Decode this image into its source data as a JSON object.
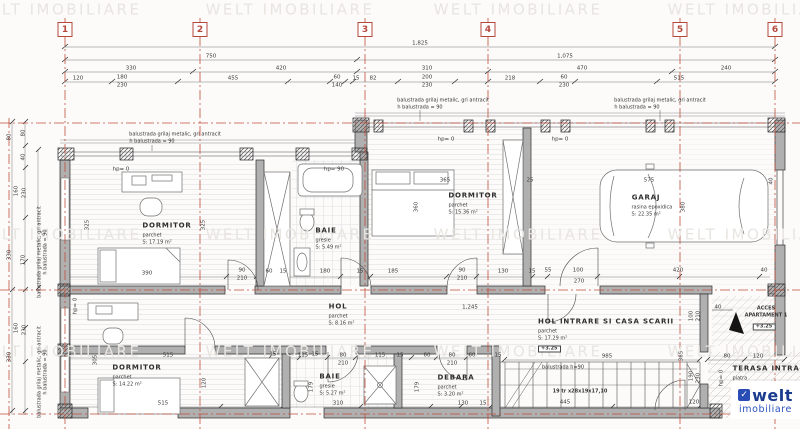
{
  "palette": {
    "red": "#b5483c",
    "line": "#3a3a3a",
    "watermark": "#e8e5e1",
    "logo_blue": "#1b3c8f",
    "logo_blue2": "#2a52be"
  },
  "watermark_text": "WELT IMOBILIARE",
  "grid_bubbles": [
    {
      "n": "1",
      "x": 65
    },
    {
      "n": "2",
      "x": 200
    },
    {
      "n": "3",
      "x": 365
    },
    {
      "n": "4",
      "x": 488
    },
    {
      "n": "5",
      "x": 680
    },
    {
      "n": "6",
      "x": 775
    }
  ],
  "rooms": [
    {
      "id": "dormitor-1",
      "name": "DORMITOR",
      "finish": "parchet",
      "area": "S: 17.19 m²",
      "x": 167,
      "y": 226
    },
    {
      "id": "baie-1",
      "name": "BAIE",
      "finish": "gresie",
      "area": "S: 5.49 m²",
      "x": 326,
      "y": 231
    },
    {
      "id": "dormitor-2",
      "name": "DORMITOR",
      "finish": "parchet",
      "area": "S: 15.36 m²",
      "x": 473,
      "y": 196
    },
    {
      "id": "garaj",
      "name": "GARAJ",
      "finish": "rasina epoxidica",
      "area": "S: 22.35 m²",
      "x": 646,
      "y": 198
    },
    {
      "id": "hol",
      "name": "HOL",
      "finish": "parchet",
      "area": "S: 8.16 m²",
      "x": 338,
      "y": 307
    },
    {
      "id": "hol-intrare",
      "name": "HOL INTRARE SI CASA SCARII",
      "finish": "parchet",
      "area": "S: 17.29 m²",
      "level": "+3.25",
      "x": 606,
      "y": 322
    },
    {
      "id": "dormitor-3",
      "name": "DORMITOR",
      "finish": "parchet",
      "area": "S: 14.22 m²",
      "x": 137,
      "y": 368
    },
    {
      "id": "baie-2",
      "name": "BAIE",
      "finish": "gresie",
      "area": "S: 5.27 m²",
      "x": 330,
      "y": 377
    },
    {
      "id": "debara",
      "name": "DEBARA",
      "finish": "parchet",
      "area": "S: 3.20 m²",
      "x": 456,
      "y": 378
    },
    {
      "id": "terasa-intrare",
      "name": "TERASA INTRARE",
      "finish": "piatra",
      "x": 772,
      "y": 369
    }
  ],
  "labels": [
    {
      "t": "WELT IMOBILIARE",
      "x": 57,
      "y": 10,
      "k": "wm",
      "n": "watermark"
    },
    {
      "t": "WELT IMOBILIARE",
      "x": 290,
      "y": 10,
      "k": "wm",
      "n": "watermark"
    },
    {
      "t": "WELT IMOBILIARE",
      "x": 518,
      "y": 10,
      "k": "wm",
      "n": "watermark"
    },
    {
      "t": "WELT IMOBILIARE",
      "x": 752,
      "y": 10,
      "k": "wm",
      "n": "watermark"
    },
    {
      "t": "WELT IMOBILIARE",
      "x": 57,
      "y": 235,
      "k": "wm",
      "n": "watermark"
    },
    {
      "t": "WELT IMOBILIARE",
      "x": 290,
      "y": 235,
      "k": "wm",
      "n": "watermark"
    },
    {
      "t": "WELT IMOBILIARE",
      "x": 518,
      "y": 235,
      "k": "wm",
      "n": "watermark"
    },
    {
      "t": "WELT IMOBILIARE",
      "x": 752,
      "y": 235,
      "k": "wm",
      "n": "watermark"
    },
    {
      "t": "WELT IMOBILIARE",
      "x": 57,
      "y": 352,
      "k": "wm",
      "n": "watermark"
    },
    {
      "t": "WELT IMOBILIARE",
      "x": 290,
      "y": 352,
      "k": "wm",
      "n": "watermark"
    },
    {
      "t": "WELT IMOBILIARE",
      "x": 518,
      "y": 352,
      "k": "wm",
      "n": "watermark"
    },
    {
      "t": "WELT IMOBILIARE",
      "x": 752,
      "y": 352,
      "k": "wm",
      "n": "watermark"
    },
    {
      "t": "1,825",
      "x": 420,
      "y": 44
    },
    {
      "t": "750",
      "x": 211,
      "y": 57
    },
    {
      "t": "1,075",
      "x": 565,
      "y": 57
    },
    {
      "t": "330",
      "x": 131,
      "y": 69
    },
    {
      "t": "420",
      "x": 281,
      "y": 69
    },
    {
      "t": "310",
      "x": 427,
      "y": 69
    },
    {
      "t": "470",
      "x": 582,
      "y": 69
    },
    {
      "t": "240",
      "x": 726,
      "y": 69
    },
    {
      "t": "120",
      "x": 78,
      "y": 79
    },
    {
      "t": "180",
      "x": 122,
      "y": 78
    },
    {
      "t": "230",
      "x": 122,
      "y": 86
    },
    {
      "t": "455",
      "x": 233,
      "y": 79
    },
    {
      "t": "60",
      "x": 337,
      "y": 78
    },
    {
      "t": "140",
      "x": 337,
      "y": 86
    },
    {
      "t": "15",
      "x": 356,
      "y": 79
    },
    {
      "t": "82",
      "x": 373,
      "y": 79
    },
    {
      "t": "200",
      "x": 427,
      "y": 78
    },
    {
      "t": "230",
      "x": 427,
      "y": 86
    },
    {
      "t": "218",
      "x": 510,
      "y": 79
    },
    {
      "t": "60",
      "x": 564,
      "y": 78
    },
    {
      "t": "230",
      "x": 564,
      "y": 86
    },
    {
      "t": "515",
      "x": 679,
      "y": 79
    },
    {
      "t": "80",
      "x": 10,
      "y": 137,
      "r": -90
    },
    {
      "t": "80",
      "x": 24,
      "y": 133,
      "r": -90
    },
    {
      "t": "40",
      "x": 24,
      "y": 157,
      "r": -90
    },
    {
      "t": "160",
      "x": 17,
      "y": 191,
      "r": -90
    },
    {
      "t": "230",
      "x": 25,
      "y": 193,
      "r": -90
    },
    {
      "t": "330",
      "x": 10,
      "y": 255,
      "r": -90
    },
    {
      "t": "170",
      "x": 24,
      "y": 260,
      "r": -90
    },
    {
      "t": "160",
      "x": 17,
      "y": 328,
      "r": -90
    },
    {
      "t": "230",
      "x": 25,
      "y": 330,
      "r": -90
    },
    {
      "t": "330",
      "x": 10,
      "y": 357,
      "r": -90
    },
    {
      "t": "575",
      "x": 649,
      "y": 181
    },
    {
      "t": "365",
      "x": 445,
      "y": 181
    },
    {
      "t": "25",
      "x": 530,
      "y": 181
    },
    {
      "t": "40",
      "x": 772,
      "y": 181,
      "r": -90
    },
    {
      "t": "380",
      "x": 684,
      "y": 207,
      "r": -90
    },
    {
      "t": "360",
      "x": 417,
      "y": 207,
      "r": -90
    },
    {
      "t": "325",
      "x": 88,
      "y": 225,
      "r": -90
    },
    {
      "t": "325",
      "x": 204,
      "y": 225,
      "r": -90
    },
    {
      "t": "390",
      "x": 147,
      "y": 274
    },
    {
      "t": "90",
      "x": 242,
      "y": 271
    },
    {
      "t": "210",
      "x": 242,
      "y": 279
    },
    {
      "t": "60",
      "x": 269,
      "y": 272
    },
    {
      "t": "15",
      "x": 283,
      "y": 272
    },
    {
      "t": "180",
      "x": 325,
      "y": 272
    },
    {
      "t": "15",
      "x": 360,
      "y": 272
    },
    {
      "t": "185",
      "x": 393,
      "y": 272
    },
    {
      "t": "90",
      "x": 462,
      "y": 271
    },
    {
      "t": "210",
      "x": 462,
      "y": 279
    },
    {
      "t": "130",
      "x": 503,
      "y": 272
    },
    {
      "t": "15",
      "x": 532,
      "y": 272
    },
    {
      "t": "55",
      "x": 548,
      "y": 271
    },
    {
      "t": "100",
      "x": 578,
      "y": 271
    },
    {
      "t": "270",
      "x": 579,
      "y": 282
    },
    {
      "t": "420",
      "x": 678,
      "y": 271
    },
    {
      "t": "40",
      "x": 764,
      "y": 271
    },
    {
      "t": "1,245",
      "x": 470,
      "y": 308
    },
    {
      "t": "40",
      "x": 718,
      "y": 308
    },
    {
      "t": "100",
      "x": 692,
      "y": 316,
      "r": -90
    },
    {
      "t": "210",
      "x": 699,
      "y": 316,
      "r": -90
    },
    {
      "t": "515",
      "x": 168,
      "y": 356
    },
    {
      "t": "15",
      "x": 273,
      "y": 355
    },
    {
      "t": "115",
      "x": 303,
      "y": 356
    },
    {
      "t": "15",
      "x": 315,
      "y": 355
    },
    {
      "t": "80",
      "x": 343,
      "y": 356
    },
    {
      "t": "210",
      "x": 343,
      "y": 364
    },
    {
      "t": "115",
      "x": 380,
      "y": 356
    },
    {
      "t": "15",
      "x": 400,
      "y": 356
    },
    {
      "t": "60",
      "x": 427,
      "y": 356
    },
    {
      "t": "80",
      "x": 452,
      "y": 356
    },
    {
      "t": "210",
      "x": 452,
      "y": 364
    },
    {
      "t": "60",
      "x": 472,
      "y": 356
    },
    {
      "t": "15",
      "x": 498,
      "y": 356
    },
    {
      "t": "985",
      "x": 607,
      "y": 357
    },
    {
      "t": "365",
      "x": 682,
      "y": 356,
      "r": -90
    },
    {
      "t": "80",
      "x": 727,
      "y": 357
    },
    {
      "t": "120",
      "x": 758,
      "y": 357
    },
    {
      "t": "305",
      "x": 96,
      "y": 360,
      "r": -90
    },
    {
      "t": "120",
      "x": 205,
      "y": 383,
      "r": -90
    },
    {
      "t": "179",
      "x": 312,
      "y": 387,
      "r": -90
    },
    {
      "t": "179",
      "x": 418,
      "y": 387,
      "r": -90
    },
    {
      "t": "190",
      "x": 692,
      "y": 376,
      "r": -90
    },
    {
      "t": "230",
      "x": 699,
      "y": 378,
      "r": -90
    },
    {
      "t": "515",
      "x": 163,
      "y": 404
    },
    {
      "t": "310",
      "x": 338,
      "y": 404
    },
    {
      "t": "130",
      "x": 463,
      "y": 404
    },
    {
      "t": "15",
      "x": 483,
      "y": 404
    },
    {
      "t": "445",
      "x": 565,
      "y": 403
    },
    {
      "t": "120",
      "x": 694,
      "y": 403
    },
    {
      "t": "hp= 0",
      "x": 121,
      "y": 170,
      "n": "parapet-height-label"
    },
    {
      "t": "hp= 0",
      "x": 446,
      "y": 140,
      "n": "parapet-height-label"
    },
    {
      "t": "hp= 0",
      "x": 560,
      "y": 140,
      "n": "parapet-height-label"
    },
    {
      "t": "hp= 90",
      "x": 334,
      "y": 170,
      "n": "parapet-height-label"
    },
    {
      "t": "hp= 0",
      "x": 76,
      "y": 306,
      "r": -90,
      "n": "parapet-height-label"
    },
    {
      "t": "hp= 0",
      "x": 722,
      "y": 378,
      "r": -90,
      "n": "parapet-height-label"
    },
    {
      "t": "balustrada grilaj metalic, gri antracit",
      "x": 175,
      "y": 135,
      "k": "nt",
      "n": "balustrade-note"
    },
    {
      "t": "h balustrada = 90",
      "x": 152,
      "y": 142,
      "k": "nt",
      "n": "balustrade-note"
    },
    {
      "t": "balustrada grilaj metalic, gri antracit",
      "x": 443,
      "y": 101,
      "k": "nt",
      "n": "balustrade-note"
    },
    {
      "t": "h balustrada = 90",
      "x": 420,
      "y": 108,
      "k": "nt",
      "n": "balustrade-note"
    },
    {
      "t": "balustrada grilaj metalic, gri antracit",
      "x": 660,
      "y": 101,
      "k": "nt",
      "n": "balustrade-note"
    },
    {
      "t": "h balustrada = 90",
      "x": 637,
      "y": 108,
      "k": "nt",
      "n": "balustrade-note"
    },
    {
      "t": "balustrada grilaj metalic, gri antracit",
      "x": 40,
      "y": 252,
      "r": -90,
      "k": "nt",
      "n": "balustrade-note"
    },
    {
      "t": "h balustrada = 90",
      "x": 46,
      "y": 252,
      "r": -90,
      "k": "nt",
      "n": "balustrade-note"
    },
    {
      "t": "balustrada grilaj metalic, gri antracit",
      "x": 40,
      "y": 372,
      "r": -90,
      "k": "nt",
      "n": "balustrade-note"
    },
    {
      "t": "h balustrada = 90",
      "x": 46,
      "y": 372,
      "r": -90,
      "k": "nt",
      "n": "balustrade-note"
    },
    {
      "t": "balustrada h=90",
      "x": 563,
      "y": 368,
      "k": "nt",
      "n": "stair-balustrade-note"
    },
    {
      "t": "19 tr x28x19x17,10",
      "x": 580,
      "y": 392,
      "s": 5,
      "w": 700,
      "n": "stair-treads-note"
    },
    {
      "t": "ACCES",
      "x": 766,
      "y": 309,
      "s": 5,
      "w": 700,
      "n": "access-label"
    },
    {
      "t": "APARTAMENT 1",
      "x": 766,
      "y": 316,
      "s": 5,
      "w": 700,
      "n": "access-label"
    },
    {
      "t": "+3.25",
      "x": 764,
      "y": 327,
      "k": "bx",
      "n": "level-marker"
    }
  ],
  "logo": {
    "name": "welt",
    "sub": "imobiliare",
    "icon": "check"
  }
}
